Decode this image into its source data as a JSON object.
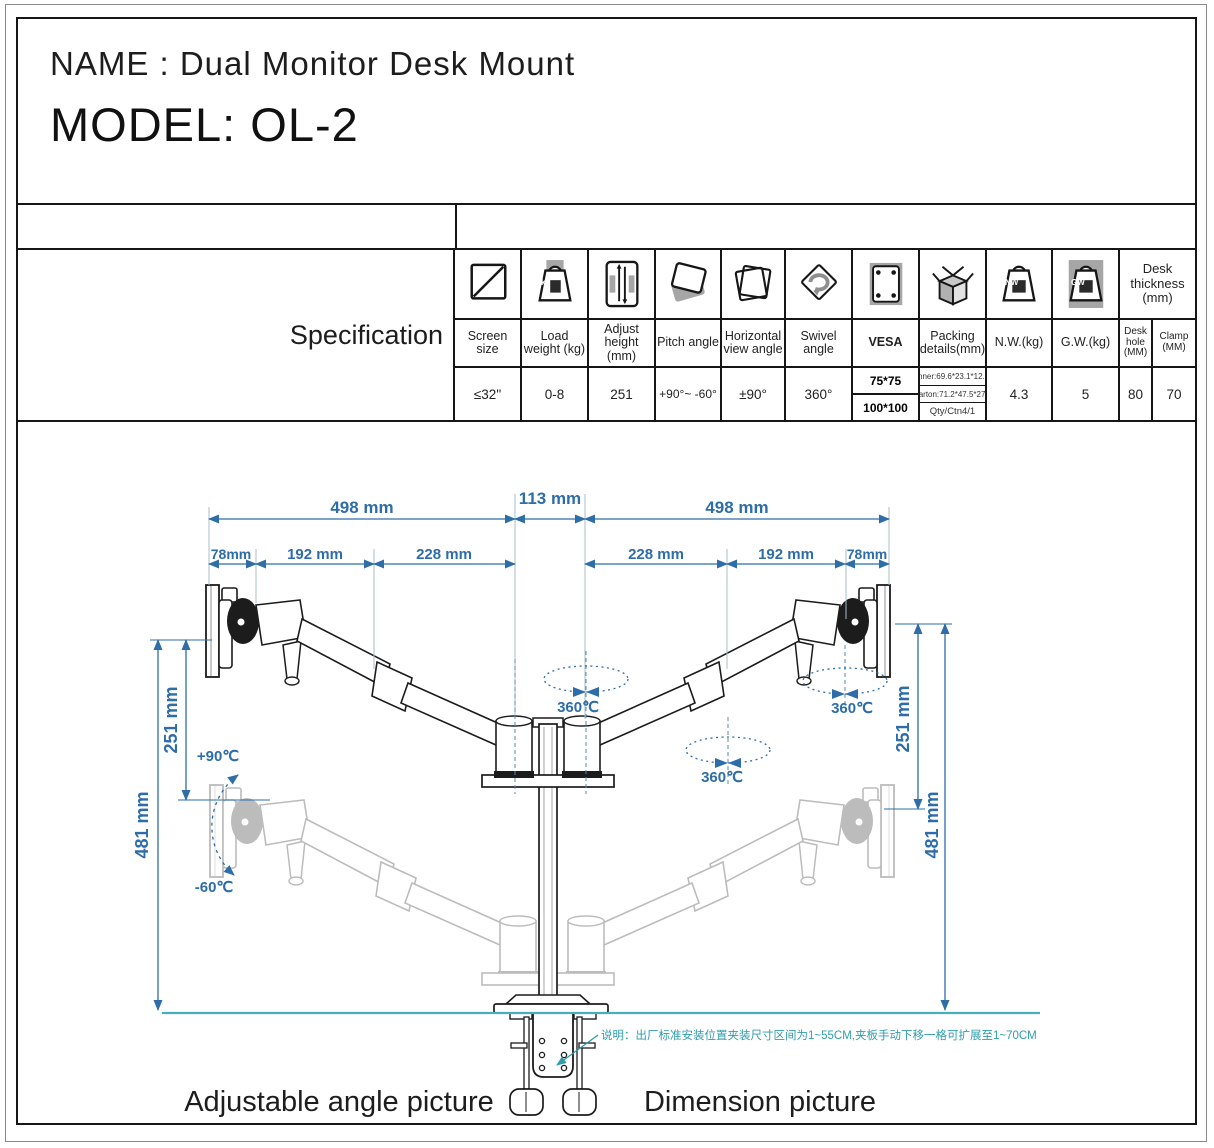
{
  "title": {
    "line1": "NAME : Dual Monitor Desk Mount",
    "line2": "MODEL: OL-2"
  },
  "spec": {
    "section_label": "Specification",
    "desk_thickness_header": "Desk thickness (mm)",
    "icon_letters": {
      "kg": "kg",
      "nw": "NW",
      "gw": "GW"
    },
    "columns": [
      {
        "icon": "screen-diagonal-icon",
        "label": "Screen size",
        "value": "≤32\""
      },
      {
        "icon": "weight-kg-icon",
        "label": "Load weight (kg)",
        "value": "0-8"
      },
      {
        "icon": "height-adjust-icon",
        "label": "Adjust height (mm)",
        "value": "251"
      },
      {
        "icon": "pitch-tilt-icon",
        "label": "Pitch angle",
        "value": "+90°~ -60°"
      },
      {
        "icon": "horizontal-view-icon",
        "label": "Horizontal view angle",
        "value": "±90°"
      },
      {
        "icon": "swivel-rotate-icon",
        "label": "Swivel angle",
        "value": "360°"
      },
      {
        "icon": "vesa-plate-icon",
        "label": "VESA",
        "values": [
          "75*75",
          "100*100"
        ]
      },
      {
        "icon": "packing-box-icon",
        "label": "Packing details(mm)",
        "values": [
          "Inner:69.6*23.1*12.3",
          "Carton:71.2*47.5*27.5",
          "Qty/Ctn4/1"
        ]
      },
      {
        "icon": "net-weight-icon",
        "label": "N.W.(kg)",
        "value": "4.3"
      },
      {
        "icon": "gross-weight-icon",
        "label": "G.W.(kg)",
        "value": "5"
      },
      {
        "label": "Desk hole (MM)",
        "value": "80"
      },
      {
        "label": "Clamp (MM)",
        "value": "70"
      }
    ]
  },
  "diagram": {
    "top_dims": [
      "498 mm",
      "113 mm",
      "498 mm"
    ],
    "sub_dims": [
      "78mm",
      "192 mm",
      "228 mm",
      "228 mm",
      "192 mm",
      "78mm"
    ],
    "left_dims": [
      "251 mm",
      "481 mm"
    ],
    "right_dims": [
      "251 mm",
      "481 mm"
    ],
    "tilt_up": "+90℃",
    "tilt_down": "-60℃",
    "swivel_labels": [
      "360℃",
      "360℃",
      "360℃"
    ],
    "note": "说明：出厂标准安装位置夹装尺寸区间为1~55CM,夹板手动下移一格可扩展至1~70CM",
    "caption_left": "Adjustable angle picture",
    "caption_right": "Dimension picture"
  },
  "colors": {
    "dimension_blue": "#2e6da8",
    "desk_teal": "#49aebc",
    "note_teal": "#2f9daa",
    "line_black": "#1c1c1c",
    "ghost_gray": "#bcbcbc",
    "icon_gray": "#a6a6a6"
  }
}
